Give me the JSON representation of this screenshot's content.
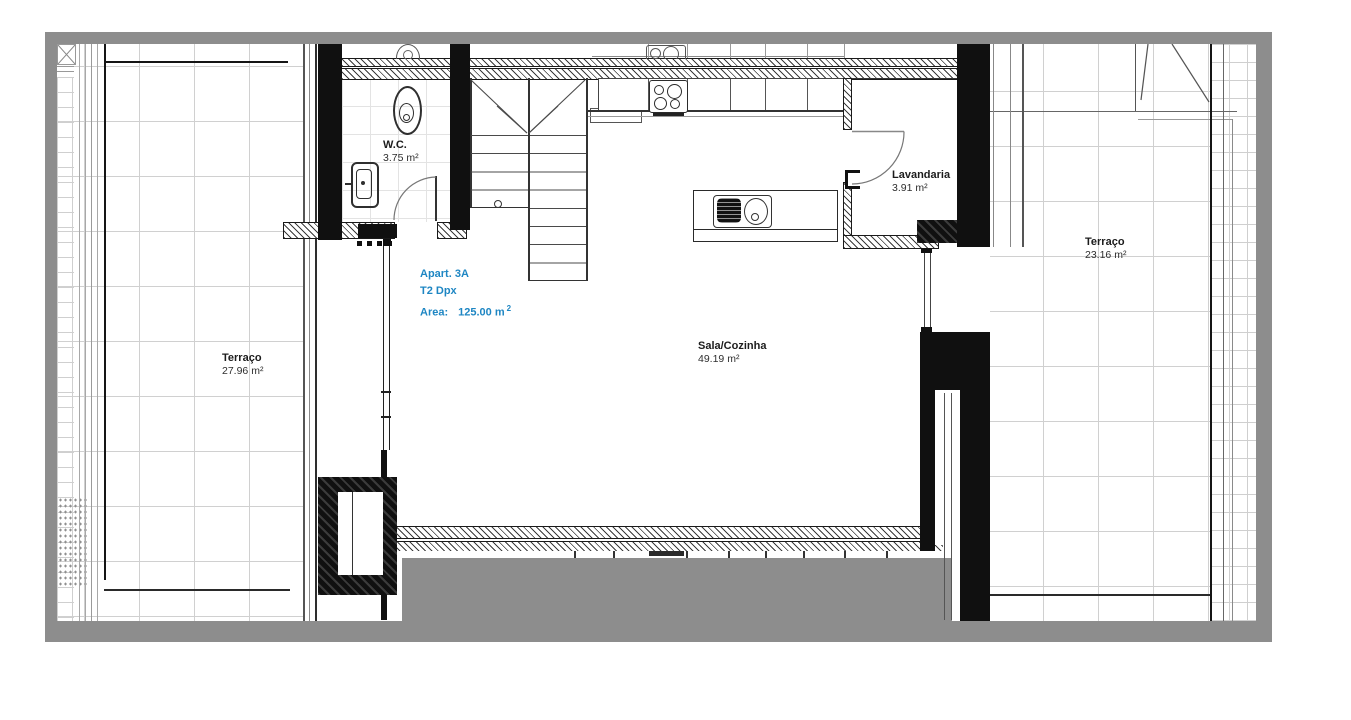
{
  "title": "Apartment floor plan",
  "apartment": {
    "name": "Apart. 3A",
    "type": "T2 Dpx",
    "area_label": "Area:",
    "area_value": "125.00 m",
    "area_sup": "2"
  },
  "rooms": {
    "wc": {
      "name": "W.C.",
      "area": "3.75 m²"
    },
    "lavandaria": {
      "name": "Lavandaria",
      "area": "3.91 m²"
    },
    "sala": {
      "name": "Sala/Cozinha",
      "area": "49.19 m²"
    },
    "terraco_left": {
      "name": "Terraço",
      "area": "27.96 m²"
    },
    "terraco_right": {
      "name": "Terraço",
      "area": "23.16 m²"
    }
  },
  "colors": {
    "accent_blue": "#1e86c3",
    "wall_black": "#111111",
    "border_gray": "#8d8d8d",
    "grid_line": "#d0d0d0"
  }
}
